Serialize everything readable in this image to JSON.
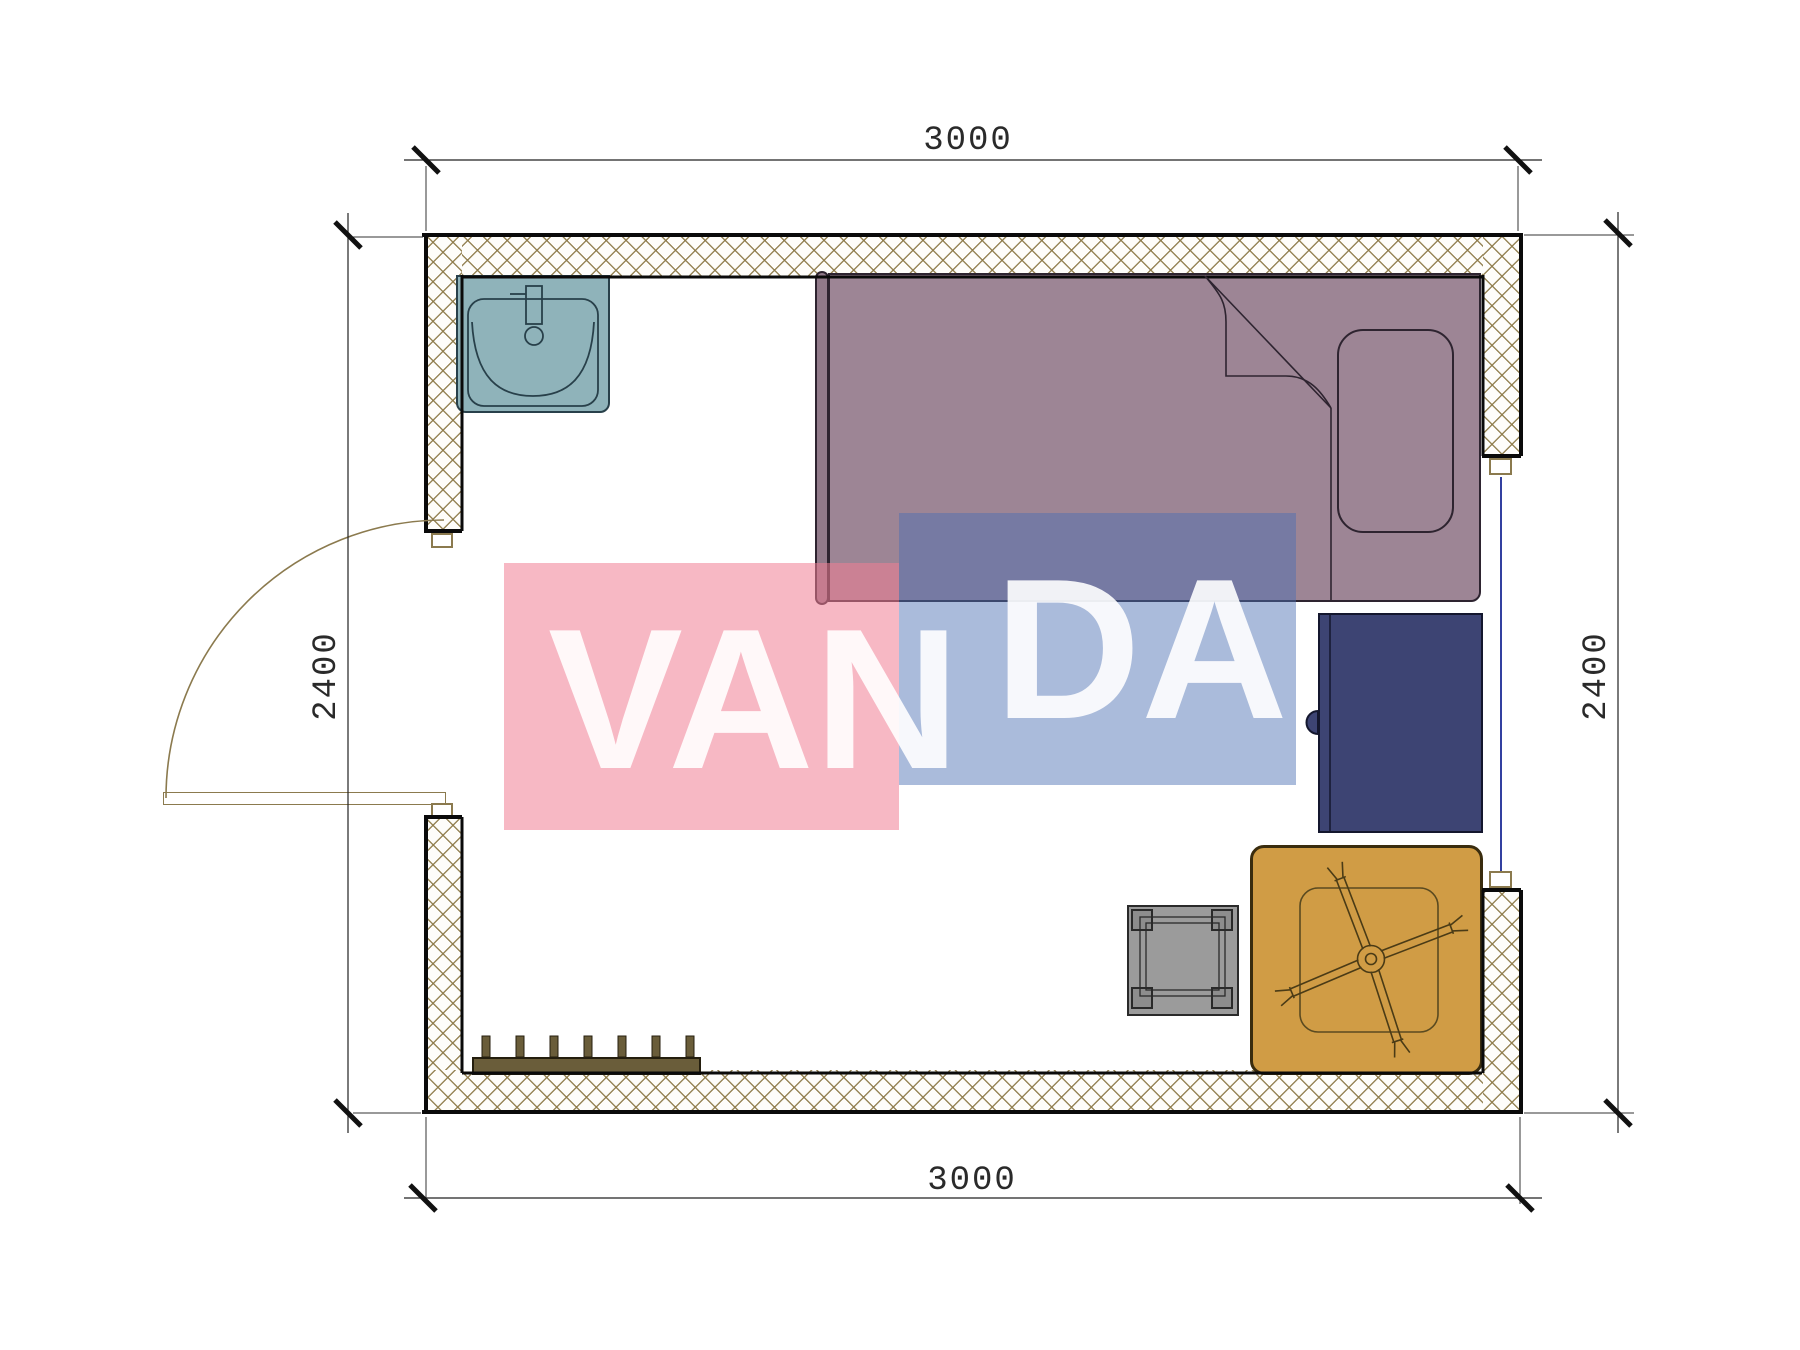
{
  "watermark": {
    "text": "VANDA",
    "part1": "VAN",
    "part2": "DA",
    "pink_color": "#f5b9c6",
    "blue_color": "#a9bedd",
    "text_color": "#ffffff"
  },
  "dimensions": {
    "top": "3000",
    "bottom": "3000",
    "left": "2400",
    "right": "2400"
  },
  "symbols": {
    "wall_hatch_color": "#8b7a4e",
    "sink_color": "#8fb3ba",
    "bed_color": "#9d8595",
    "desk_color": "#3d4473",
    "stool_color": "#9b9b9b",
    "table_color": "#d09c45",
    "coat_rack_color": "#6a5d3a",
    "window_glass_color": "#3340a0",
    "symbol_names": [
      "sink-icon",
      "single-bed-icon",
      "pillow-icon",
      "desk-icon",
      "stool-icon",
      "table-with-rack-icon",
      "coat-rack-icon",
      "door-swing-icon",
      "window-icon"
    ]
  }
}
